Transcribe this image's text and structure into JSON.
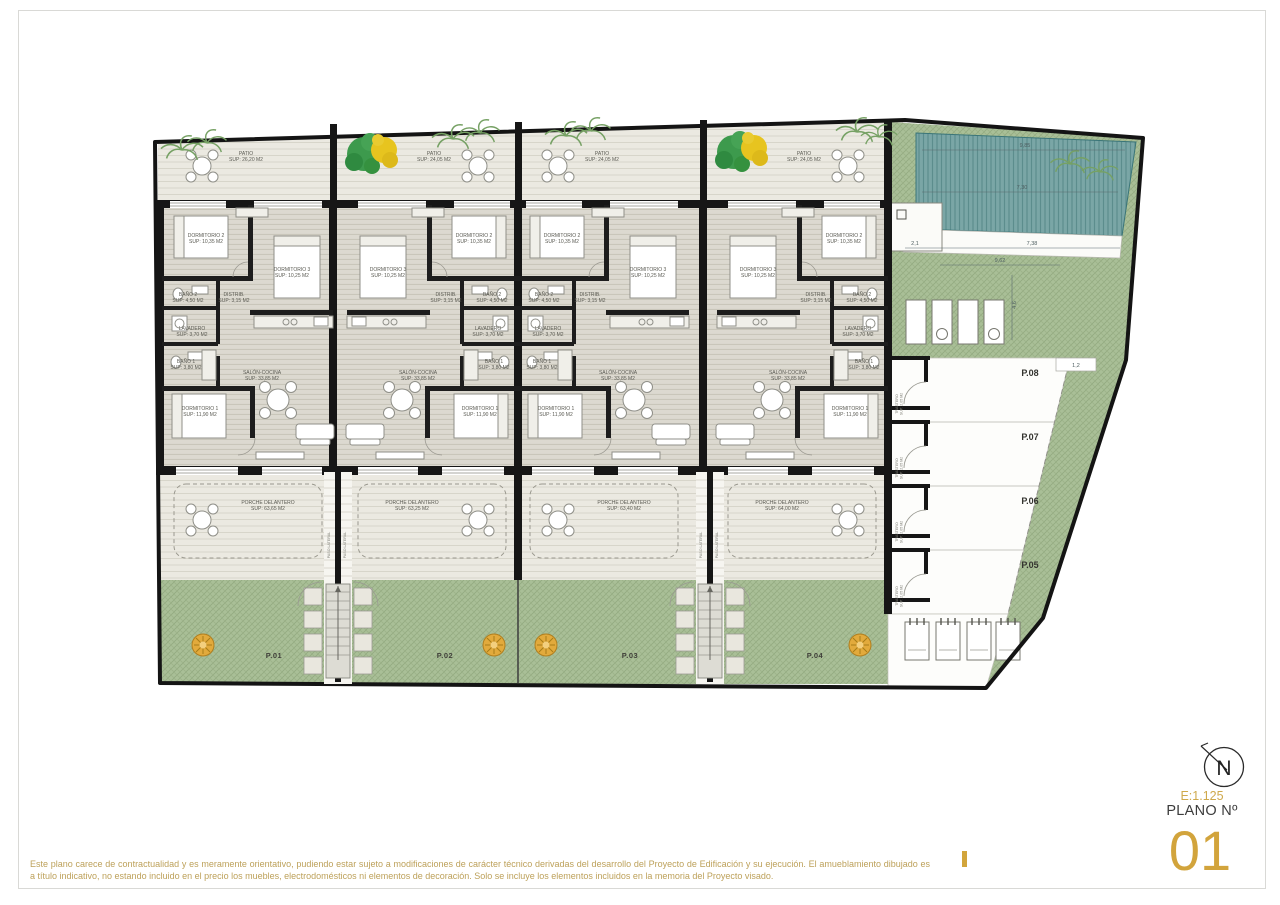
{
  "title_block": {
    "scale": "E:1.125",
    "plano_label": "PLANO Nº",
    "plano_number": "01",
    "north_letter": "N"
  },
  "disclaimer": {
    "text": "Este plano carece de contractualidad y es meramente orientativo, pudiendo estar sujeto a modificaciones de carácter técnico derivadas del desarrollo del Proyecto de Edificación y su ejecución. El amueblamiento dibujado es a título indicativo, no estando incluido en el precio los muebles, electrodomésticos ni elementos de decoración. Solo se incluye los elementos incluidos en la memoria del Proyecto visado."
  },
  "colors": {
    "accent_gold": "#d2a43c",
    "garden_green": "#a9bf97",
    "pool_teal": "#7aa6a6",
    "wall_black": "#1b1b1b"
  },
  "plan": {
    "units": [
      {
        "plot": "P.01",
        "rooms": {
          "patio": {
            "name": "PATIO",
            "area": "SUP: 26,20 M2"
          },
          "dorm2": {
            "name": "DORMITORIO 2",
            "area": "SUP: 10,35 M2"
          },
          "dorm3": {
            "name": "DORMITORIO 3",
            "area": "SUP: 10,25 M2"
          },
          "bano2": {
            "name": "BAÑO 2",
            "area": "SUP: 4,50 M2"
          },
          "distrib": {
            "name": "DISTRIB.",
            "area": "SUP: 3,15 M2"
          },
          "lavadero": {
            "name": "LAVADERO",
            "area": "SUP: 3,70 M2"
          },
          "bano1": {
            "name": "BAÑO 1",
            "area": "SUP: 3,80 M2"
          },
          "dorm1": {
            "name": "DORMITORIO 1",
            "area": "SUP: 11,90 M2"
          },
          "salon": {
            "name": "SALÓN-COCINA",
            "area": "SUP: 33,85 M2"
          },
          "porche": {
            "name": "PORCHE DELANTERO",
            "area": "SUP: 63,65 M2"
          }
        }
      },
      {
        "plot": "P.02",
        "rooms": {
          "patio": {
            "name": "PATIO",
            "area": "SUP: 24,05 M2"
          },
          "dorm2": {
            "name": "DORMITORIO 2",
            "area": "SUP: 10,35 M2"
          },
          "dorm3": {
            "name": "DORMITORIO 3",
            "area": "SUP: 10,25 M2"
          },
          "bano2": {
            "name": "BAÑO 2",
            "area": "SUP: 4,50 M2"
          },
          "distrib": {
            "name": "DISTRIB.",
            "area": "SUP: 3,15 M2"
          },
          "lavadero": {
            "name": "LAVADERO",
            "area": "SUP: 3,70 M2"
          },
          "bano1": {
            "name": "BAÑO 1",
            "area": "SUP: 3,80 M2"
          },
          "dorm1": {
            "name": "DORMITORIO 1",
            "area": "SUP: 11,90 M2"
          },
          "salon": {
            "name": "SALÓN-COCINA",
            "area": "SUP: 33,85 M2"
          },
          "porche": {
            "name": "PORCHE DELANTERO",
            "area": "SUP: 63,25 M2"
          }
        }
      },
      {
        "plot": "P.03",
        "rooms": {
          "patio": {
            "name": "PATIO",
            "area": "SUP: 24,05 M2"
          },
          "dorm2": {
            "name": "DORMITORIO 2",
            "area": "SUP: 10,35 M2"
          },
          "dorm3": {
            "name": "DORMITORIO 3",
            "area": "SUP: 10,25 M2"
          },
          "bano2": {
            "name": "BAÑO 2",
            "area": "SUP: 4,50 M2"
          },
          "distrib": {
            "name": "DISTRIB.",
            "area": "SUP: 3,15 M2"
          },
          "lavadero": {
            "name": "LAVADERO",
            "area": "SUP: 3,70 M2"
          },
          "bano1": {
            "name": "BAÑO 1",
            "area": "SUP: 3,80 M2"
          },
          "dorm1": {
            "name": "DORMITORIO 1",
            "area": "SUP: 11,90 M2"
          },
          "salon": {
            "name": "SALÓN-COCINA",
            "area": "SUP: 33,85 M2"
          },
          "porche": {
            "name": "PORCHE DELANTERO",
            "area": "SUP: 63,40 M2"
          }
        }
      },
      {
        "plot": "P.04",
        "rooms": {
          "patio": {
            "name": "PATIO",
            "area": "SUP: 24,05 M2"
          },
          "dorm2": {
            "name": "DORMITORIO 2",
            "area": "SUP: 10,35 M2"
          },
          "dorm3": {
            "name": "DORMITORIO 3",
            "area": "SUP: 10,25 M2"
          },
          "bano2": {
            "name": "BAÑO 2",
            "area": "SUP: 4,50 M2"
          },
          "distrib": {
            "name": "DISTRIB.",
            "area": "SUP: 3,15 M2"
          },
          "lavadero": {
            "name": "LAVADERO",
            "area": "SUP: 3,70 M2"
          },
          "bano1": {
            "name": "BAÑO 1",
            "area": "SUP: 3,80 M2"
          },
          "dorm1": {
            "name": "DORMITORIO 1",
            "area": "SUP: 11,90 M2"
          },
          "salon": {
            "name": "SALÓN-COCINA",
            "area": "SUP: 33,85 M2"
          },
          "porche": {
            "name": "PORCHE DELANTERO",
            "area": "SUP: 64,00 M2"
          }
        }
      }
    ],
    "passage": {
      "label": "PASO LATERAL"
    },
    "parking": {
      "spaces": [
        "P.08",
        "P.07",
        "P.06",
        "P.05"
      ],
      "trastero": {
        "name": "TRASTERO",
        "area": "SUP: 2,05 M2"
      }
    },
    "pool": {
      "dims": {
        "top": "9,85",
        "mid": "7,30",
        "deck_left": "2,1",
        "deck_right": "7,38",
        "entry": "1,2",
        "green": "9,62",
        "side": "4,6"
      }
    }
  }
}
